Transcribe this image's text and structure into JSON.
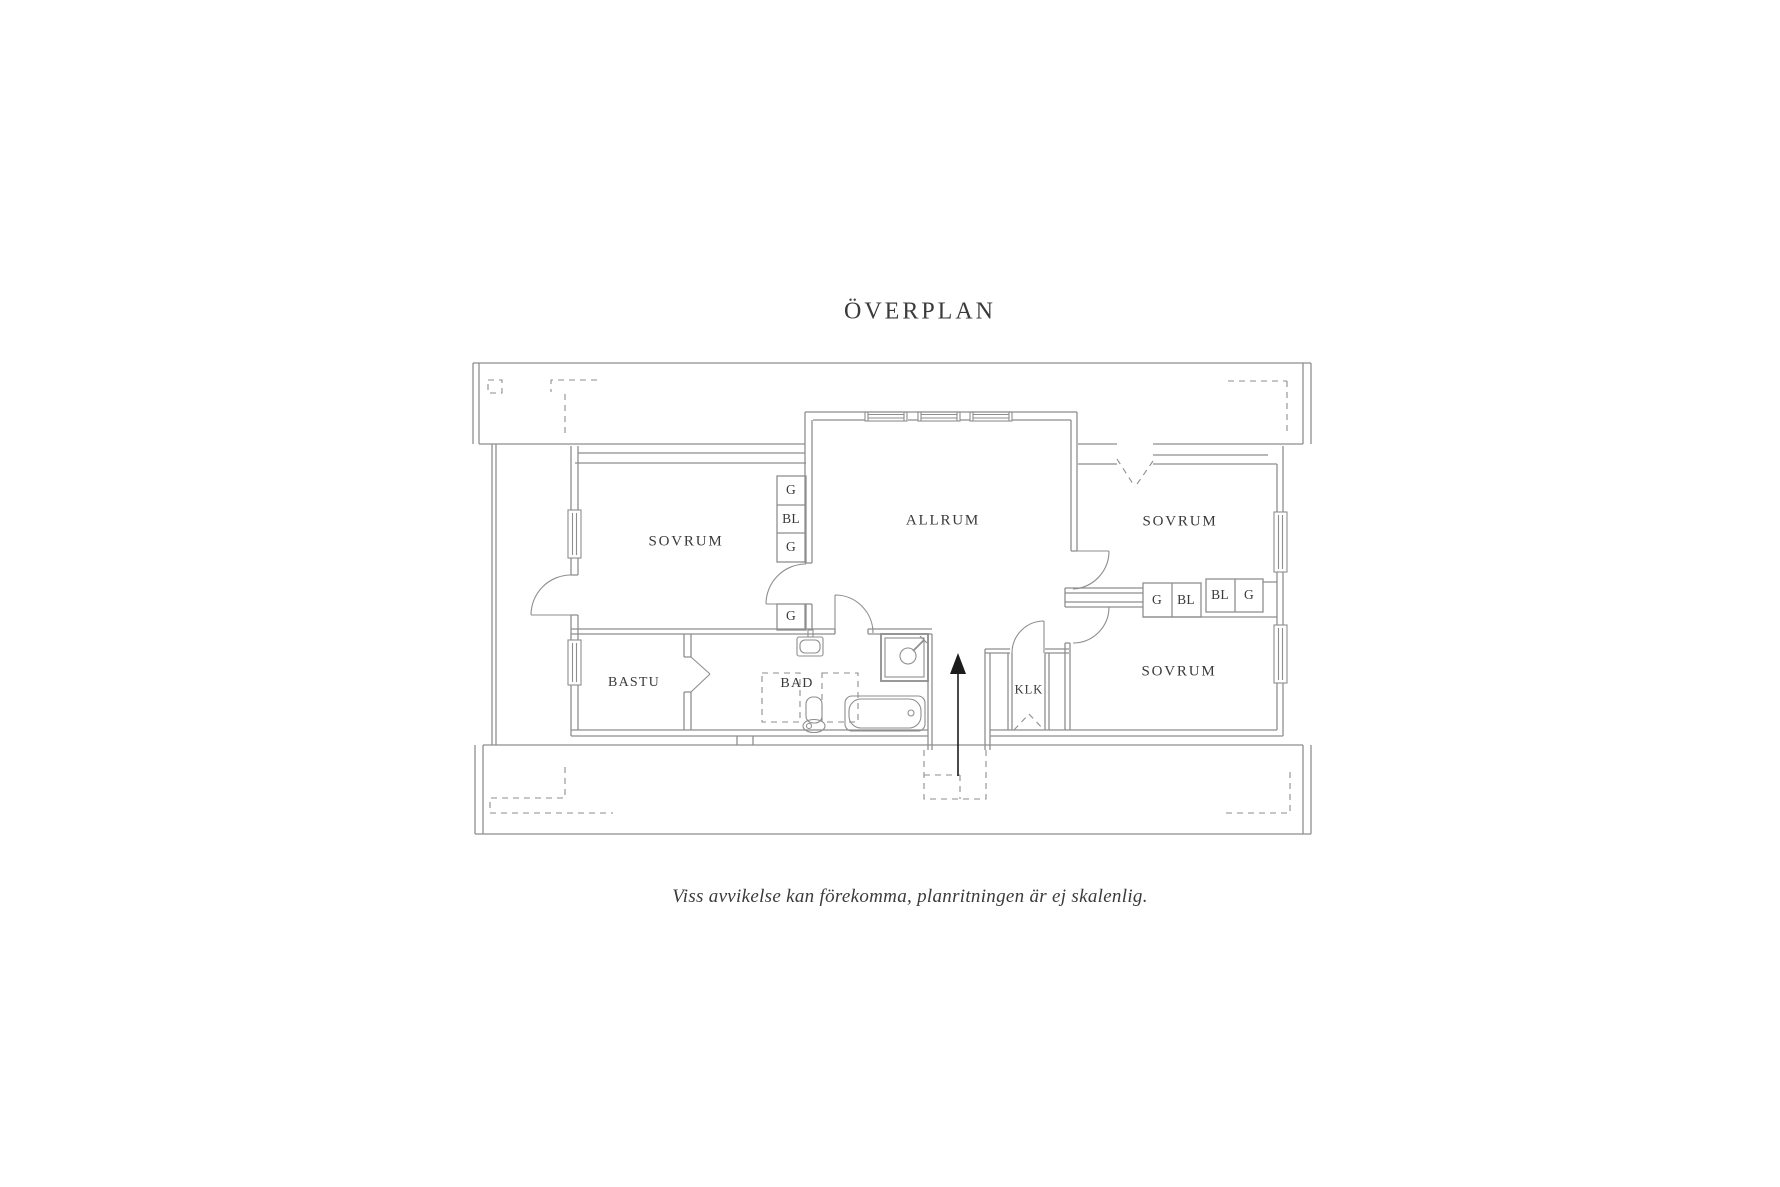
{
  "title": "ÖVERPLAN",
  "caption": "Viss avvikelse kan förekomma, planritningen är ej skalenlig.",
  "rooms": [
    {
      "label": "SOVRUM"
    },
    {
      "label": "ALLRUM"
    },
    {
      "label": "SOVRUM"
    },
    {
      "label": "SOVRUM"
    },
    {
      "label": "BASTU"
    },
    {
      "label": "BAD"
    },
    {
      "label": "KLK"
    }
  ],
  "closets": [
    {
      "label": "G"
    },
    {
      "label": "BL"
    },
    {
      "label": "G"
    },
    {
      "label": "G"
    },
    {
      "label": "G"
    },
    {
      "label": "BL"
    },
    {
      "label": "BL"
    },
    {
      "label": "G"
    }
  ],
  "colors": {
    "background": "#ffffff",
    "line": "#8e8e8e",
    "text": "#3a3a3a",
    "arrow": "#1c1c1c"
  }
}
